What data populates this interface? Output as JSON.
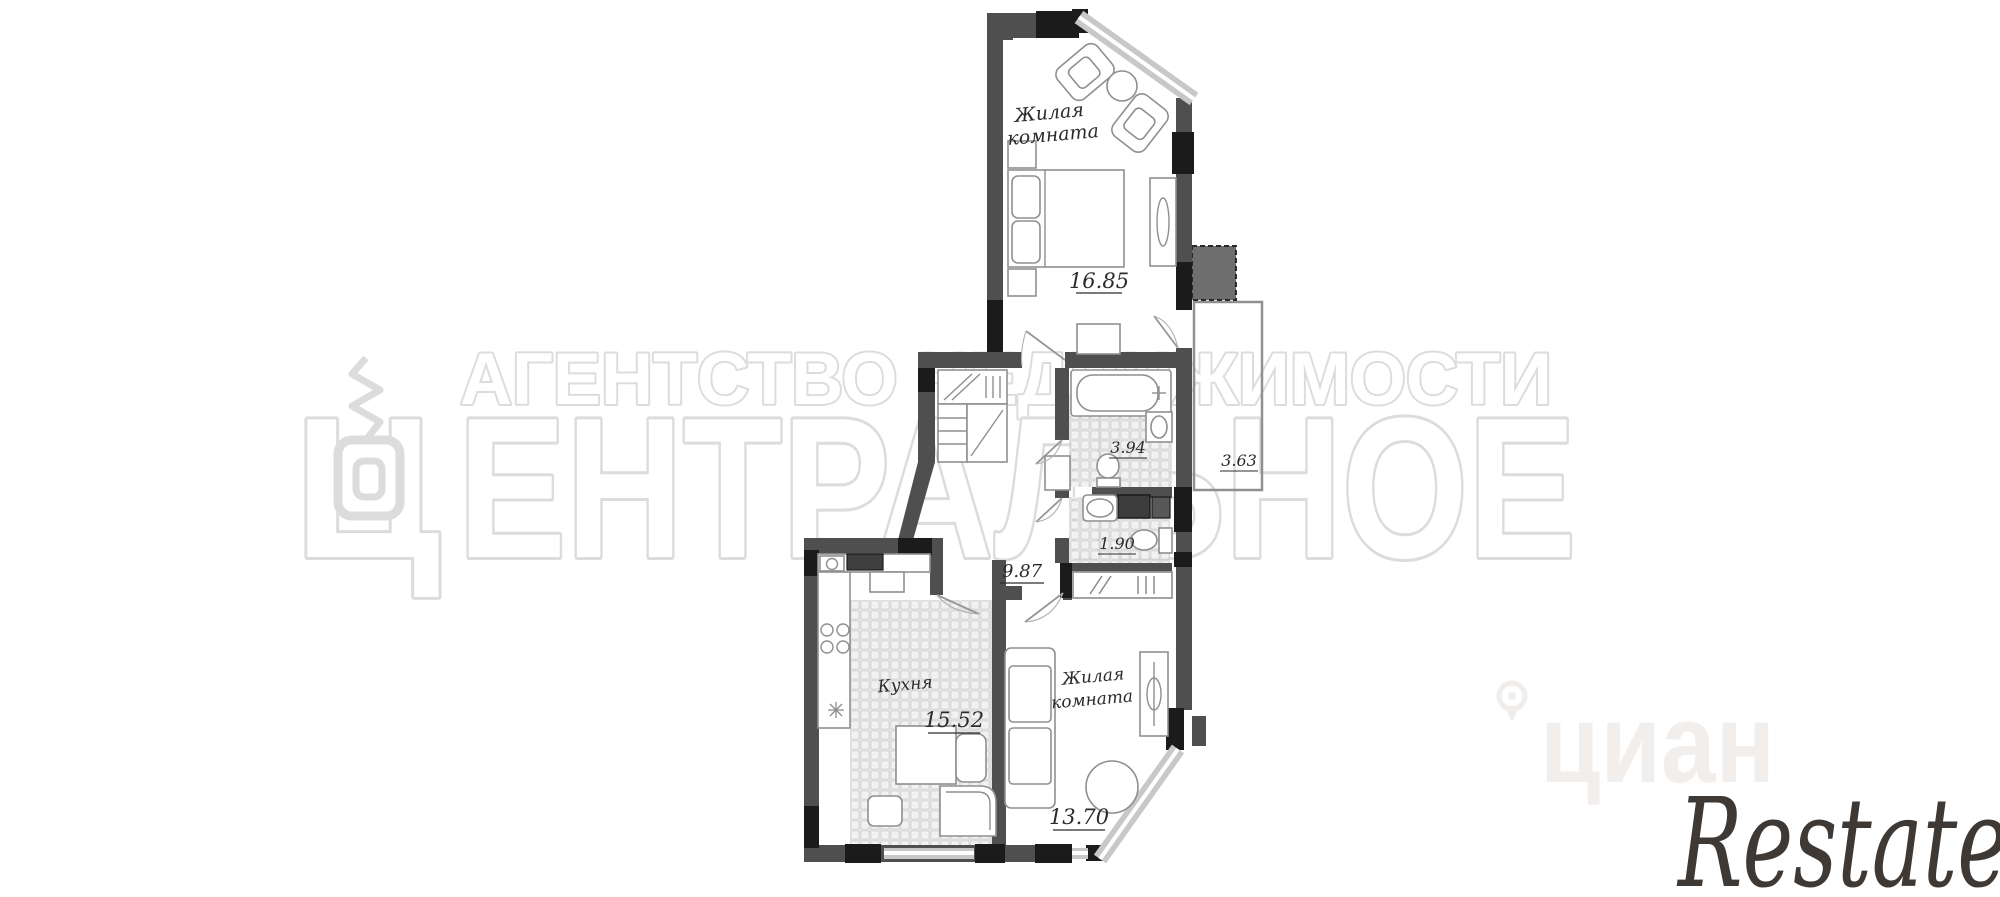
{
  "canvas": {
    "width": 2000,
    "height": 897,
    "background": "#ffffff"
  },
  "watermarks": {
    "agency": {
      "line1": "АГЕНТСТВО НЕДВИЖИМОСТИ",
      "logo_letter": "Ц",
      "line2": "ЕНТРАЛЬНОЕ",
      "outline_color": "#dcdcdc"
    },
    "cian": {
      "text": "циан",
      "color": "#f1eeeb"
    },
    "restate": {
      "text": "Restate",
      "color": "#3e3935"
    }
  },
  "floorplan": {
    "colors": {
      "wall": "#4f4f4f",
      "wall_dark": "#1b1b1b",
      "window": "#c8c8c8",
      "tile_line": "#cdcdcd",
      "furniture_line": "#8f8f8f",
      "label": "#2b2b2b"
    },
    "rooms": {
      "bedroom": {
        "name_line1": "Жилая",
        "name_line2": "комната",
        "area": "16.85"
      },
      "bathroom": {
        "area": "3.94"
      },
      "wc": {
        "area": "1.90"
      },
      "hallway": {
        "area": "9.87"
      },
      "kitchen": {
        "name": "Кухня",
        "area": "15.52"
      },
      "living": {
        "name_line1": "Жилая",
        "name_line2": "комната",
        "area": "13.70"
      },
      "balcony": {
        "area": "3.63"
      }
    }
  }
}
